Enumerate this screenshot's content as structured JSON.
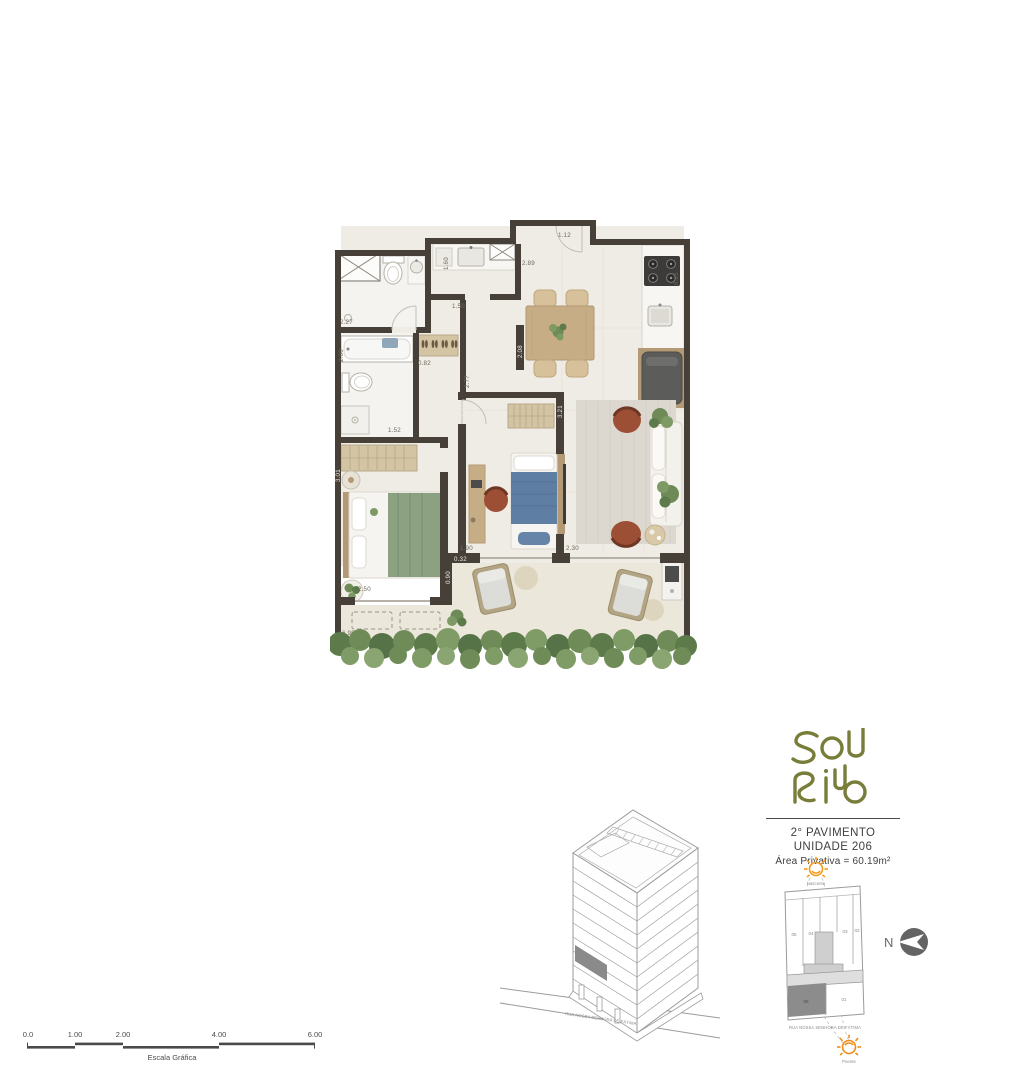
{
  "plan": {
    "dimensions": {
      "d112": "1.12",
      "d289": "2.89",
      "d625": "6.25",
      "d160": "1.60",
      "d150": "1.50",
      "d227": "2.27",
      "d200": "2.00",
      "d082": "0.82",
      "d152": "1.52",
      "d277": "2.77",
      "d310": "3.10",
      "d321": "3.21",
      "d208": "2.08",
      "d301": "3.01",
      "d250": "2.50",
      "d699": "6.99",
      "d190": "1.90",
      "d032": "0.32",
      "d230": "2.30",
      "d090": "0.90"
    }
  },
  "info": {
    "logo_text": "SOL RIO",
    "floor_label": "2° PAVIMENTO",
    "unit_label": "UNIDADE 206",
    "area_label": "Área Privativa = 60.19m²"
  },
  "site_plan": {
    "sun_top_label": "Nascente",
    "sun_bottom_label": "Poente",
    "street": "RUA NOSSA SENHORA DE FÁTIMA",
    "units_top": [
      "05",
      "04",
      "03",
      "02"
    ],
    "units_bottom": [
      "06",
      "01"
    ],
    "highlighted_unit": "06"
  },
  "compass": {
    "north_label": "N"
  },
  "building": {
    "street": "RUA NOSSA SENHORA DE FÁTIMA"
  },
  "scale_bar": {
    "ticks": [
      "0.0",
      "1.00",
      "2.00",
      "4.00",
      "6.00"
    ],
    "caption": "Escala Gráfica"
  },
  "colors": {
    "wall": "#474038",
    "logo_olive": "#787d3a",
    "sun_orange": "#f59b1e",
    "terracotta": "#9c4f35",
    "plant_green": "#6d8a57"
  }
}
